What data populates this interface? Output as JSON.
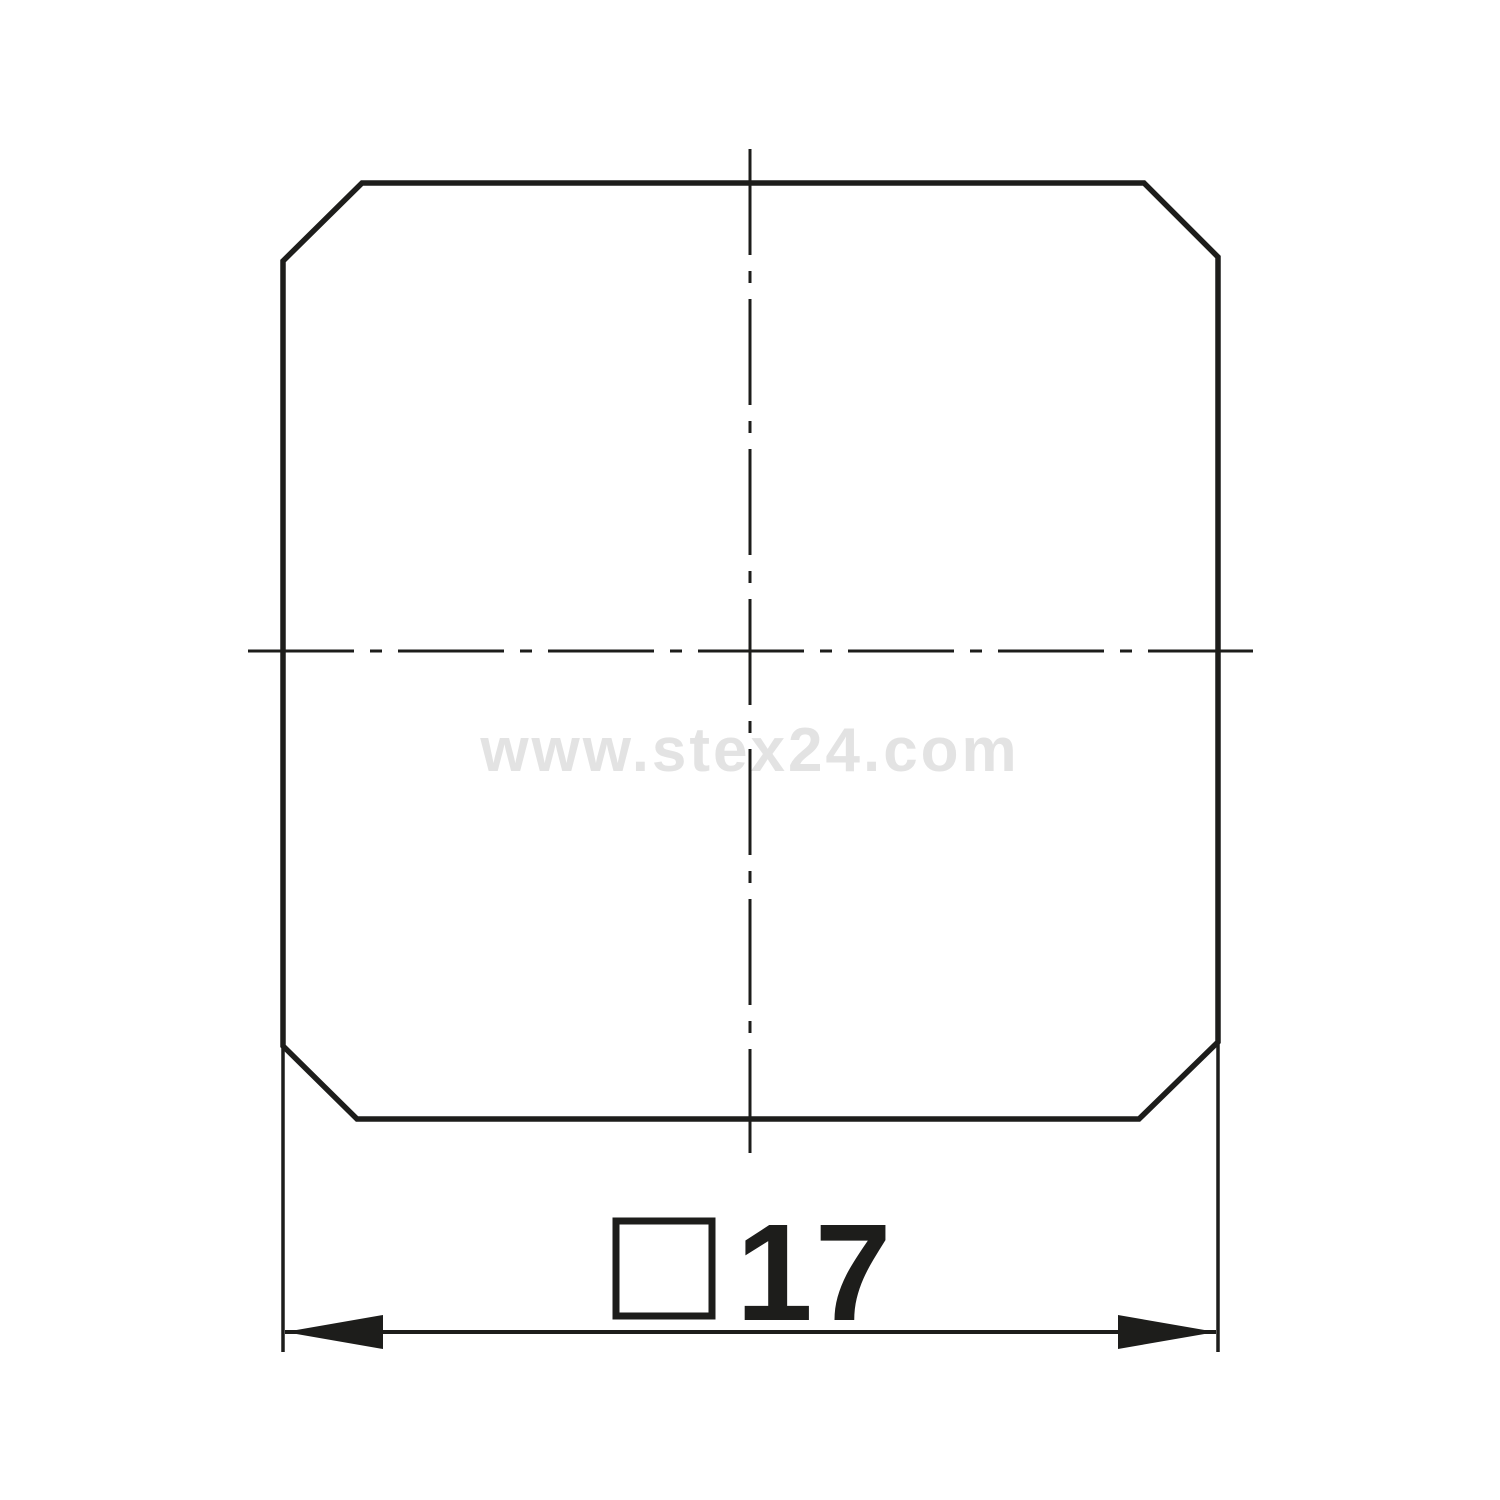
{
  "page": {
    "background_color": "#ffffff"
  },
  "drawing": {
    "watermark": "www.stex24.com",
    "colors": {
      "line": "#1d1d1b",
      "watermark": "#e3e3e3"
    },
    "dimension": {
      "symbol_icon": "square-symbol",
      "value": "17"
    }
  }
}
